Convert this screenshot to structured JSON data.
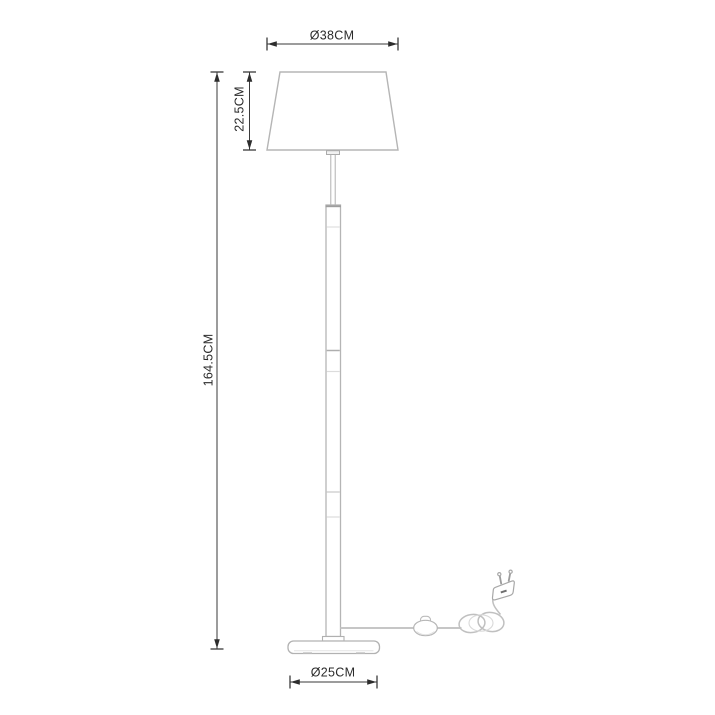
{
  "diagram": {
    "type": "product-dimension-drawing",
    "product": "floor-lamp",
    "colors": {
      "background": "#ffffff",
      "lamp_outline": "#b9b9b9",
      "dimension_lines": "#3a3a3a",
      "label_text": "#2b2b2b"
    },
    "dimensions": {
      "shade_diameter": {
        "label": "Ø38CM",
        "value_cm": 38
      },
      "shade_height": {
        "label": "22.5CM",
        "value_cm": 22.5
      },
      "total_height": {
        "label": "164.5CM",
        "value_cm": 164.5
      },
      "base_diameter": {
        "label": "Ø25CM",
        "value_cm": 25
      }
    },
    "parts": [
      "lamp-shade",
      "stem-rod",
      "pole",
      "pole-flange",
      "lamp-base",
      "power-cord",
      "inline-switch",
      "coiled-cord",
      "euro-plug"
    ]
  }
}
